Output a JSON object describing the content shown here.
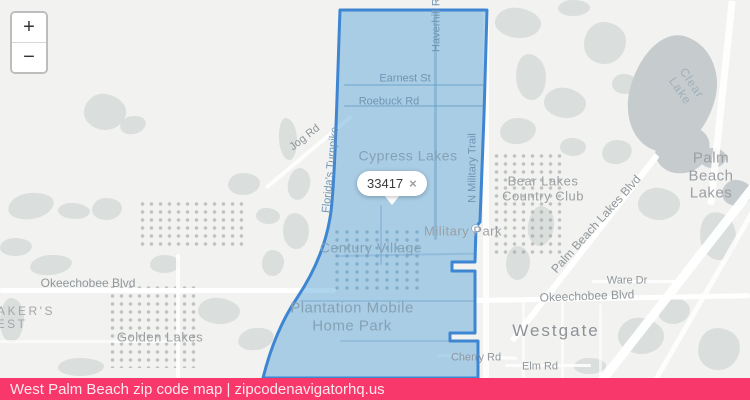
{
  "attribution": {
    "text": "West Palm Beach zip code map | zipcodenavigatorhq.us"
  },
  "controls": {
    "zoom_in": "+",
    "zoom_out": "−"
  },
  "popup": {
    "zip_code": "33417",
    "close_label": "×"
  },
  "colors": {
    "attribution_bar": "#f8386b",
    "boundary_stroke": "#3e86d2",
    "boundary_fill": "rgba(77,159,214,0.45)",
    "lake": "#c6cbce"
  },
  "map": {
    "region_zip": "33417",
    "labels": [
      {
        "name": "label-earnest-st",
        "text": "Earnest St",
        "x": 405,
        "y": 79,
        "size": 11,
        "cls": "cls-roadBlue",
        "rot": 0
      },
      {
        "name": "label-roebuck-rd",
        "text": "Roebuck Rd",
        "x": 389,
        "y": 102,
        "size": 11,
        "cls": "cls-roadBlue",
        "rot": 0
      },
      {
        "name": "label-cypress-lakes",
        "text": "Cypress Lakes",
        "x": 408,
        "y": 156,
        "size": 14,
        "cls": "cls-areaBlue",
        "rot": 0
      },
      {
        "name": "label-century-village",
        "text": "Century Village",
        "x": 371,
        "y": 248,
        "size": 14,
        "cls": "cls-areaBlue",
        "rot": 0
      },
      {
        "name": "label-plantation-mobile-home-park",
        "text": "Plantation Mobile\nHome Park",
        "x": 352,
        "y": 317,
        "size": 15,
        "cls": "cls-areaBlue",
        "rot": 0
      },
      {
        "name": "label-military-park",
        "text": "Military Park",
        "x": 463,
        "y": 231,
        "size": 13,
        "cls": "cls-areaGray",
        "rot": 0
      },
      {
        "name": "label-jog-rd",
        "text": "Jog Rd",
        "x": 305,
        "y": 138,
        "size": 11,
        "cls": "cls-roadGray",
        "rot": -38
      },
      {
        "name": "label-floridas-turnpike",
        "text": "Florida's Turnpike",
        "x": 331,
        "y": 170,
        "size": 11,
        "cls": "cls-roadBlue",
        "rot": -84
      },
      {
        "name": "label-n-military-trail",
        "text": "N Military Trail",
        "x": 473,
        "y": 168,
        "size": 11,
        "cls": "cls-roadBlue",
        "rot": -90
      },
      {
        "name": "label-haverhill-rd",
        "text": "Haverhill Rd",
        "x": 437,
        "y": 22,
        "size": 11,
        "cls": "cls-roadBlue",
        "rot": -90
      },
      {
        "name": "label-okeechobee-blvd-west",
        "text": "Okeechobee Blvd",
        "x": 88,
        "y": 283,
        "size": 12,
        "cls": "cls-roadGray",
        "rot": 0
      },
      {
        "name": "label-golden-lakes",
        "text": "Golden Lakes",
        "x": 160,
        "y": 337,
        "size": 13,
        "cls": "cls-areaGray",
        "rot": 0
      },
      {
        "name": "label-edge-partial-1",
        "text": "AKER'S",
        "x": 26,
        "y": 311,
        "size": 12,
        "cls": "cls-edge",
        "rot": 0
      },
      {
        "name": "label-edge-partial-2",
        "text": "EST",
        "x": 12,
        "y": 324,
        "size": 12,
        "cls": "cls-edge",
        "rot": 0
      },
      {
        "name": "label-bear-lakes-country-club",
        "text": "Bear Lakes\nCountry Club",
        "x": 543,
        "y": 189,
        "size": 13,
        "cls": "cls-areaGray",
        "rot": 0
      },
      {
        "name": "label-palm-beach-lakes-blvd",
        "text": "Palm Beach Lakes Blvd",
        "x": 596,
        "y": 224,
        "size": 12,
        "cls": "cls-roadGray",
        "rot": -48
      },
      {
        "name": "label-ware-dr",
        "text": "Ware Dr",
        "x": 627,
        "y": 281,
        "size": 11,
        "cls": "cls-roadGray",
        "rot": 0
      },
      {
        "name": "label-okeechobee-blvd-east",
        "text": "Okeechobee Blvd",
        "x": 587,
        "y": 296,
        "size": 12,
        "cls": "cls-roadGray",
        "rot": -2
      },
      {
        "name": "label-westgate",
        "text": "Westgate",
        "x": 556,
        "y": 331,
        "size": 17,
        "cls": "cls-big",
        "rot": 0
      },
      {
        "name": "label-cherry-rd",
        "text": "Cherry Rd",
        "x": 476,
        "y": 358,
        "size": 11,
        "cls": "cls-roadGray",
        "rot": 0
      },
      {
        "name": "label-elm-rd",
        "text": "Elm Rd",
        "x": 540,
        "y": 367,
        "size": 11,
        "cls": "cls-roadGray",
        "rot": 0
      },
      {
        "name": "label-clear-lake",
        "text": "Clear Lake",
        "x": 686,
        "y": 87,
        "size": 12,
        "cls": "cls-water",
        "rot": 56
      },
      {
        "name": "label-palm-beach-lakes",
        "text": "Palm Beach\nLakes",
        "x": 711,
        "y": 176,
        "size": 15,
        "cls": "cls-areaGray",
        "rot": 0
      }
    ]
  }
}
